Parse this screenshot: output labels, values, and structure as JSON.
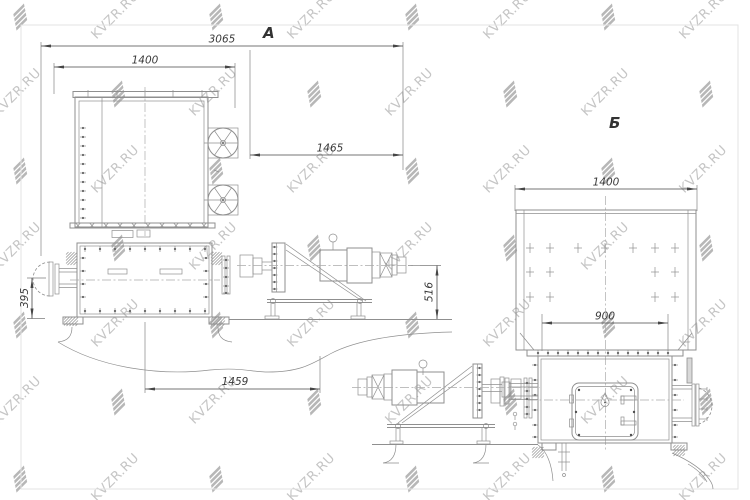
{
  "watermark": {
    "text": "KVZR.RU"
  },
  "drawing": {
    "type": "technical-drawing",
    "views": [
      {
        "id": "A",
        "label": "А",
        "dims": {
          "overall_length": "3065",
          "body_width": "1400",
          "drive_length": "1465",
          "inlet_height": "395",
          "drive_height": "516",
          "bottom_length": "1459"
        }
      },
      {
        "id": "B",
        "label": "Б",
        "dims": {
          "body_width": "1400",
          "bolt_span": "900"
        }
      }
    ]
  },
  "colors": {
    "line": "#8f8f8f",
    "dimension": "#474747",
    "text": "#3a3a3a",
    "watermark_text": "#c5c5c5",
    "watermark_logo": "#b7b7b7",
    "frame": "#e3e3e3",
    "plate_fill": "#d9d9d9",
    "background": "#ffffff"
  }
}
